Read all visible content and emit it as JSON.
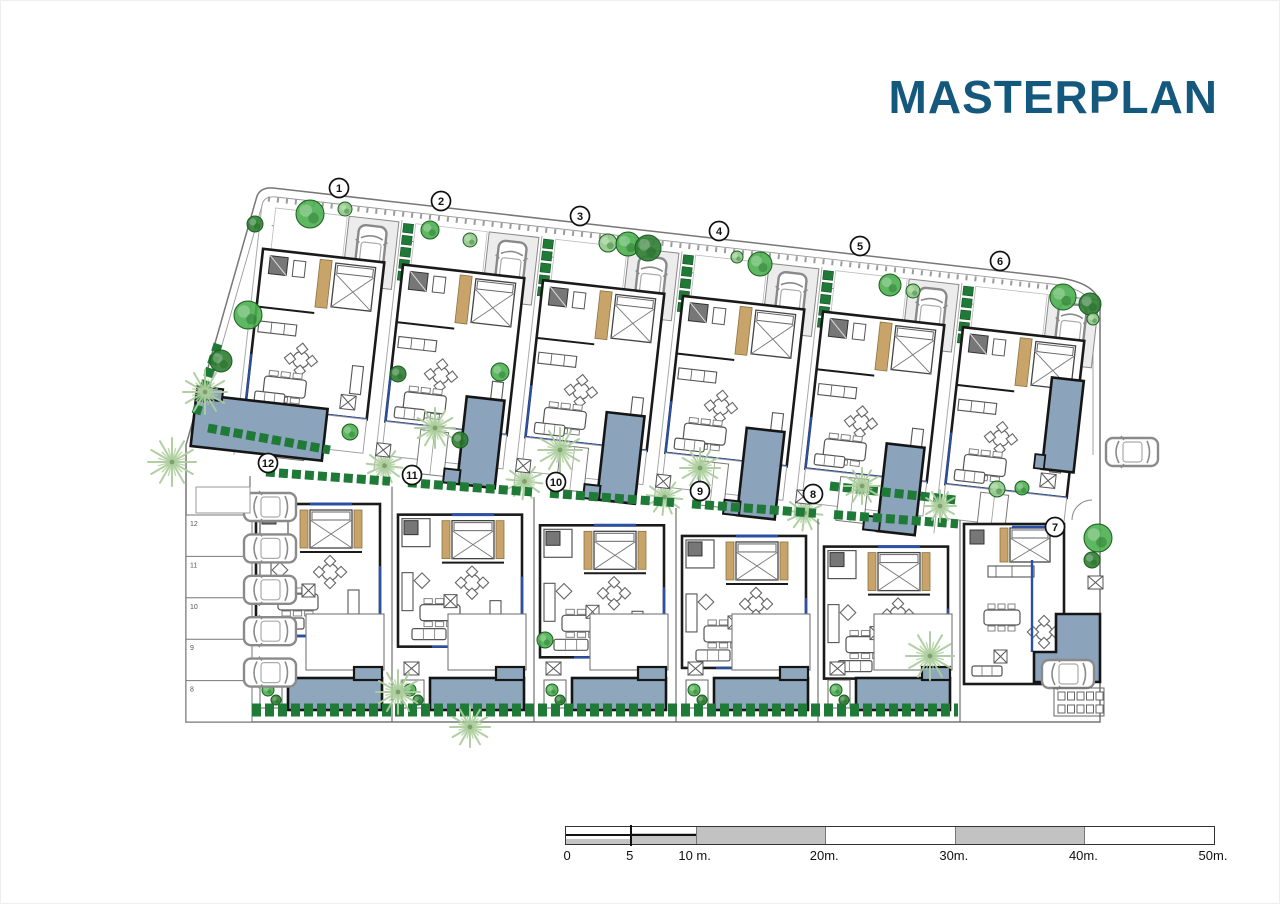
{
  "page": {
    "title": "MASTERPLAN",
    "title_color": "#15587E",
    "background": "#ffffff"
  },
  "plan": {
    "villa_labels": [
      {
        "n": "1",
        "x": 339,
        "y": 188
      },
      {
        "n": "2",
        "x": 441,
        "y": 201
      },
      {
        "n": "3",
        "x": 580,
        "y": 216
      },
      {
        "n": "4",
        "x": 719,
        "y": 231
      },
      {
        "n": "5",
        "x": 860,
        "y": 246
      },
      {
        "n": "6",
        "x": 1000,
        "y": 261
      },
      {
        "n": "7",
        "x": 1055,
        "y": 527
      },
      {
        "n": "8",
        "x": 813,
        "y": 494
      },
      {
        "n": "9",
        "x": 700,
        "y": 491
      },
      {
        "n": "10",
        "x": 556,
        "y": 482
      },
      {
        "n": "11",
        "x": 412,
        "y": 475
      },
      {
        "n": "12",
        "x": 268,
        "y": 463
      }
    ],
    "parking_labels": [
      "12",
      "11",
      "10",
      "9",
      "8"
    ],
    "colors": {
      "pool_top": "#8BA3BB",
      "pool_bottom": "#8FA7BC",
      "pool_border": "#151515",
      "tree_dark": "#2E7D32",
      "tree_mid": "#4CAF50",
      "tree_light": "#90C987",
      "hedge": "#1E7A36",
      "palm": "#ACCe9C",
      "wall": "#1a1a1a",
      "line": "#8a8a8a",
      "tan": "#C8A36A",
      "glazing": "#2B4FA3",
      "paving": "#ececec",
      "car": "#8a8a8a"
    }
  },
  "scale_bar": {
    "max": 50,
    "values": [
      0,
      5,
      10,
      20,
      30,
      40,
      50
    ],
    "labels": [
      "0",
      "5",
      "10 m.",
      "20m.",
      "30m.",
      "40m.",
      "50m."
    ]
  }
}
